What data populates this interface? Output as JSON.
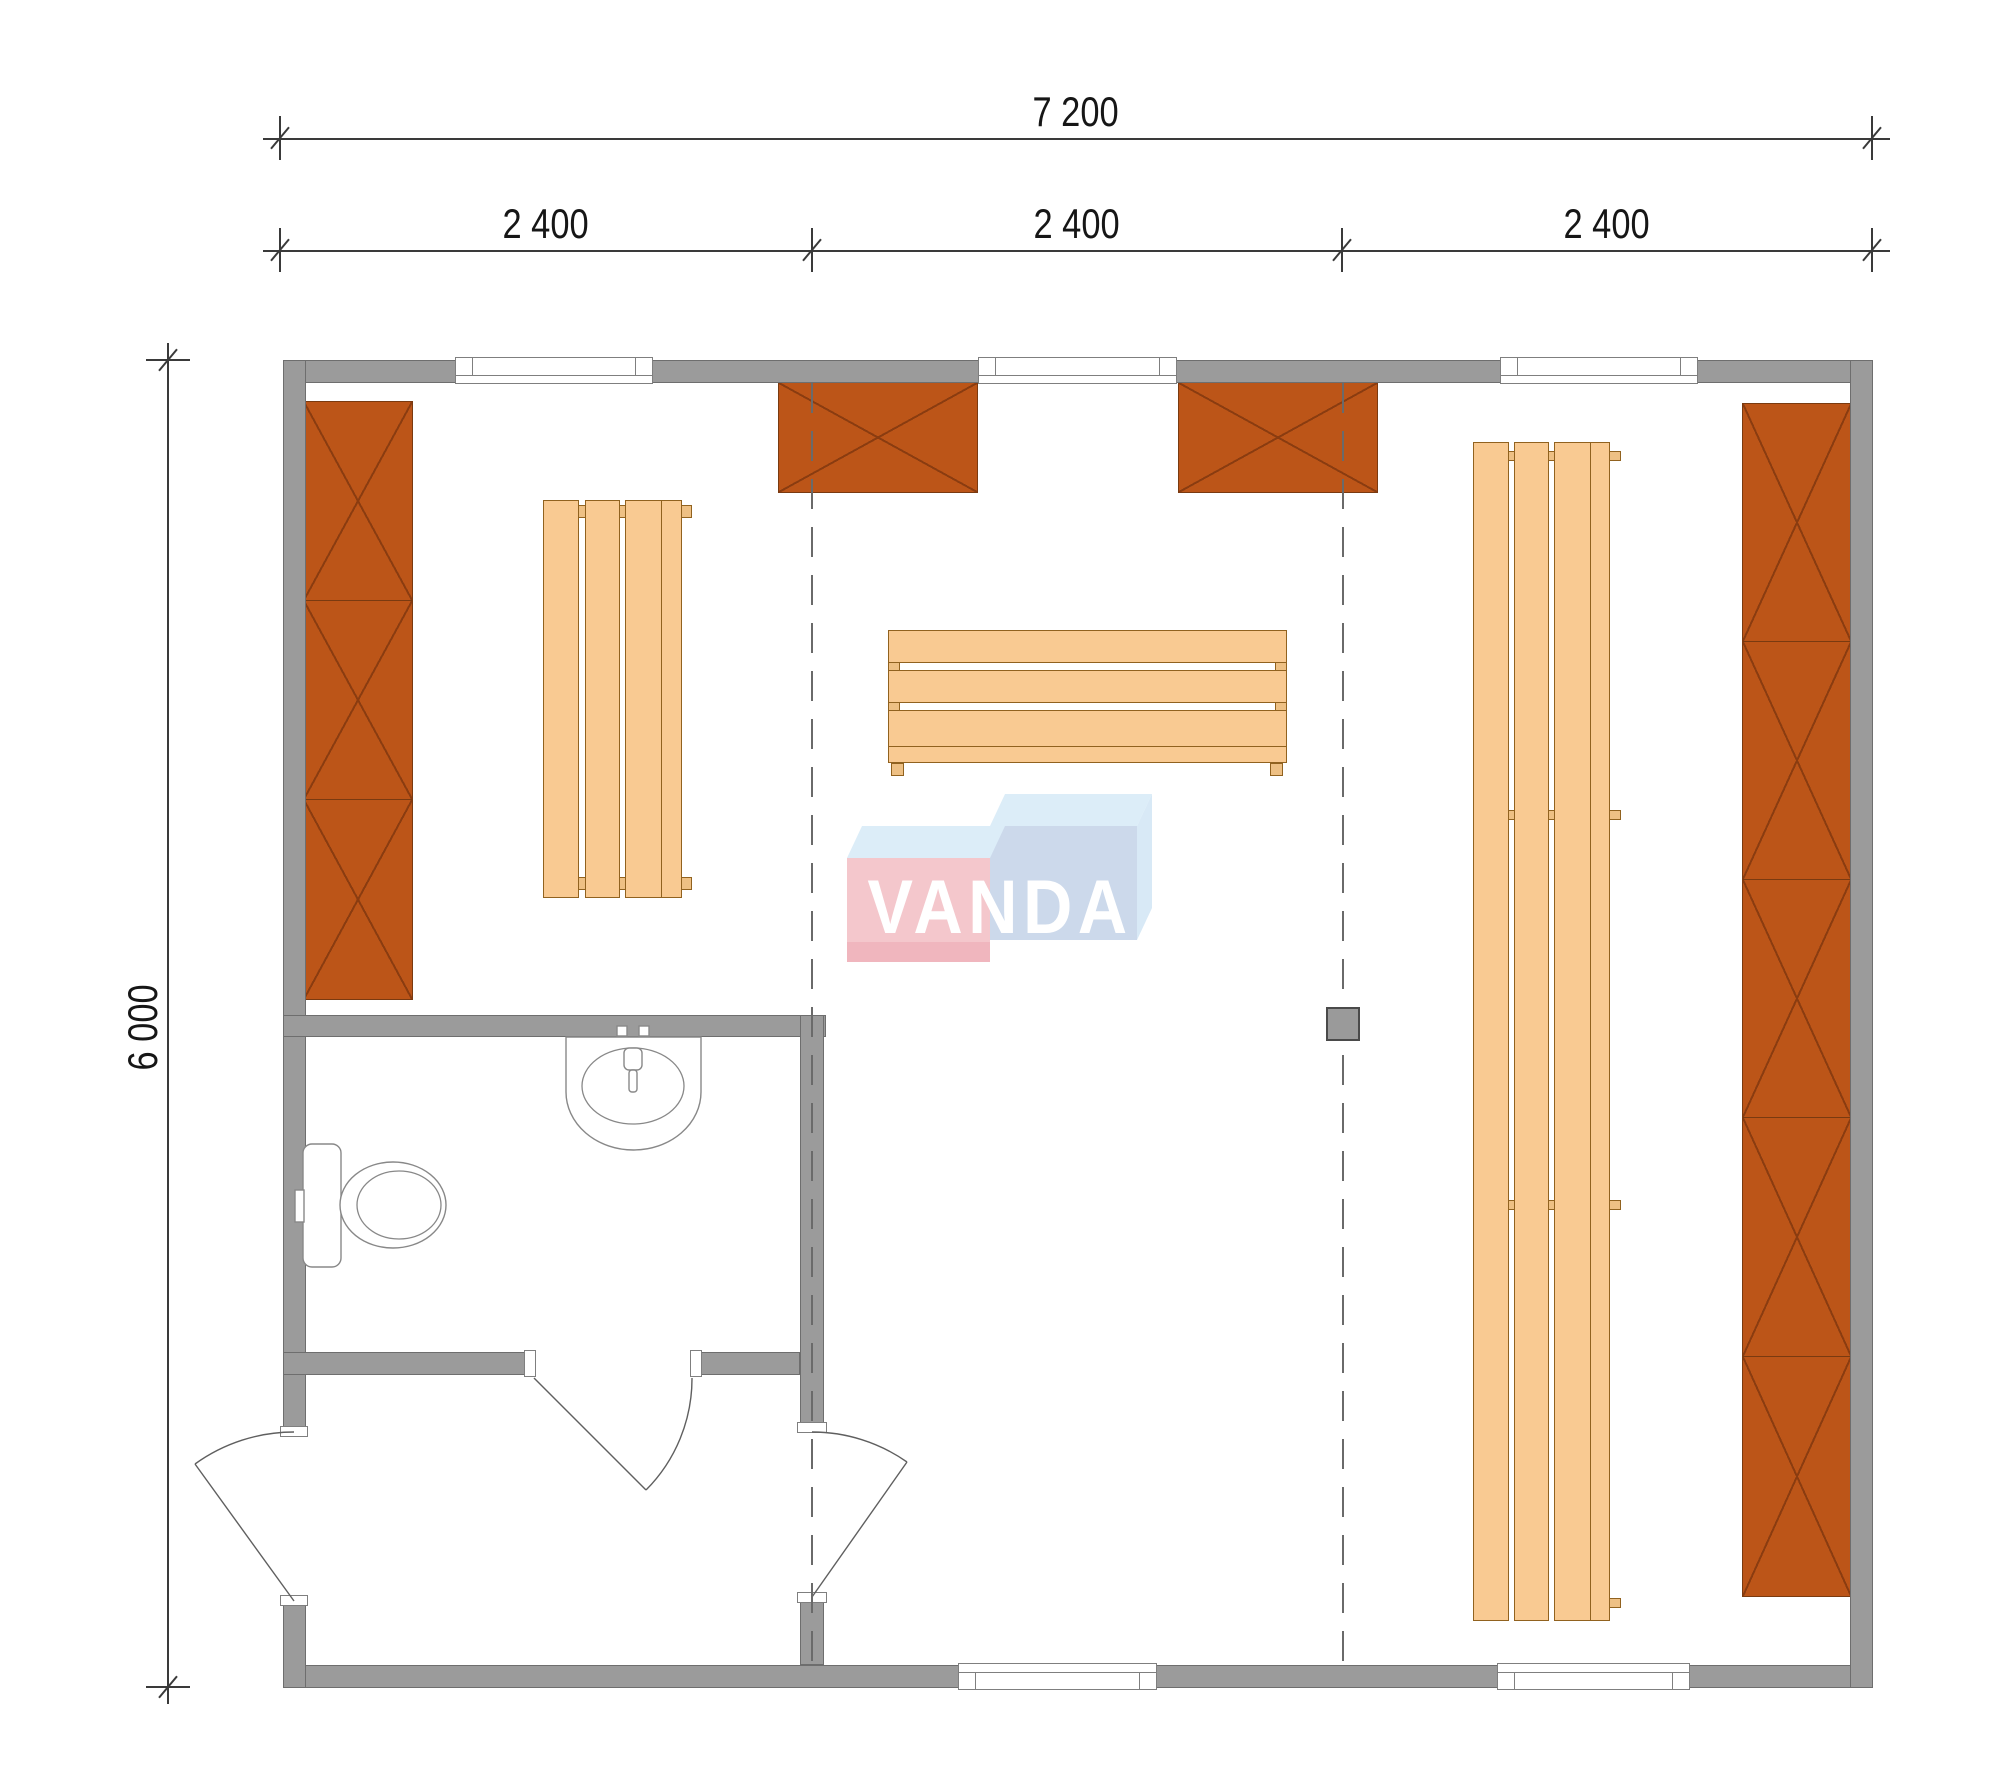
{
  "drawing": {
    "watermark": "VANDA",
    "dims": {
      "total": "7 200",
      "bays": [
        "2 400",
        "2 400",
        "2 400"
      ],
      "height": "6 000"
    }
  },
  "colors": {
    "wall_fill": "#9b9b9b",
    "wall_edge": "#6e6e6e",
    "cabinet_fill": "#bc5518",
    "cabinet_edge": "#7a3a10",
    "cabinet_line": "#8a3c10",
    "wood_fill": "#f9ca92",
    "wood_edge": "#91621f",
    "wood_tab": "#eec084",
    "logo_pink": "#f4c7cc",
    "logo_blue": "#ccd9eb",
    "logo_top": "#dcedf8",
    "logo_text": "#ffffff",
    "dash_line": "#6a6a6a",
    "dimension": "#3a3a3a",
    "fixture_line": "#888888",
    "stove_fill": "#9a9a9a"
  }
}
